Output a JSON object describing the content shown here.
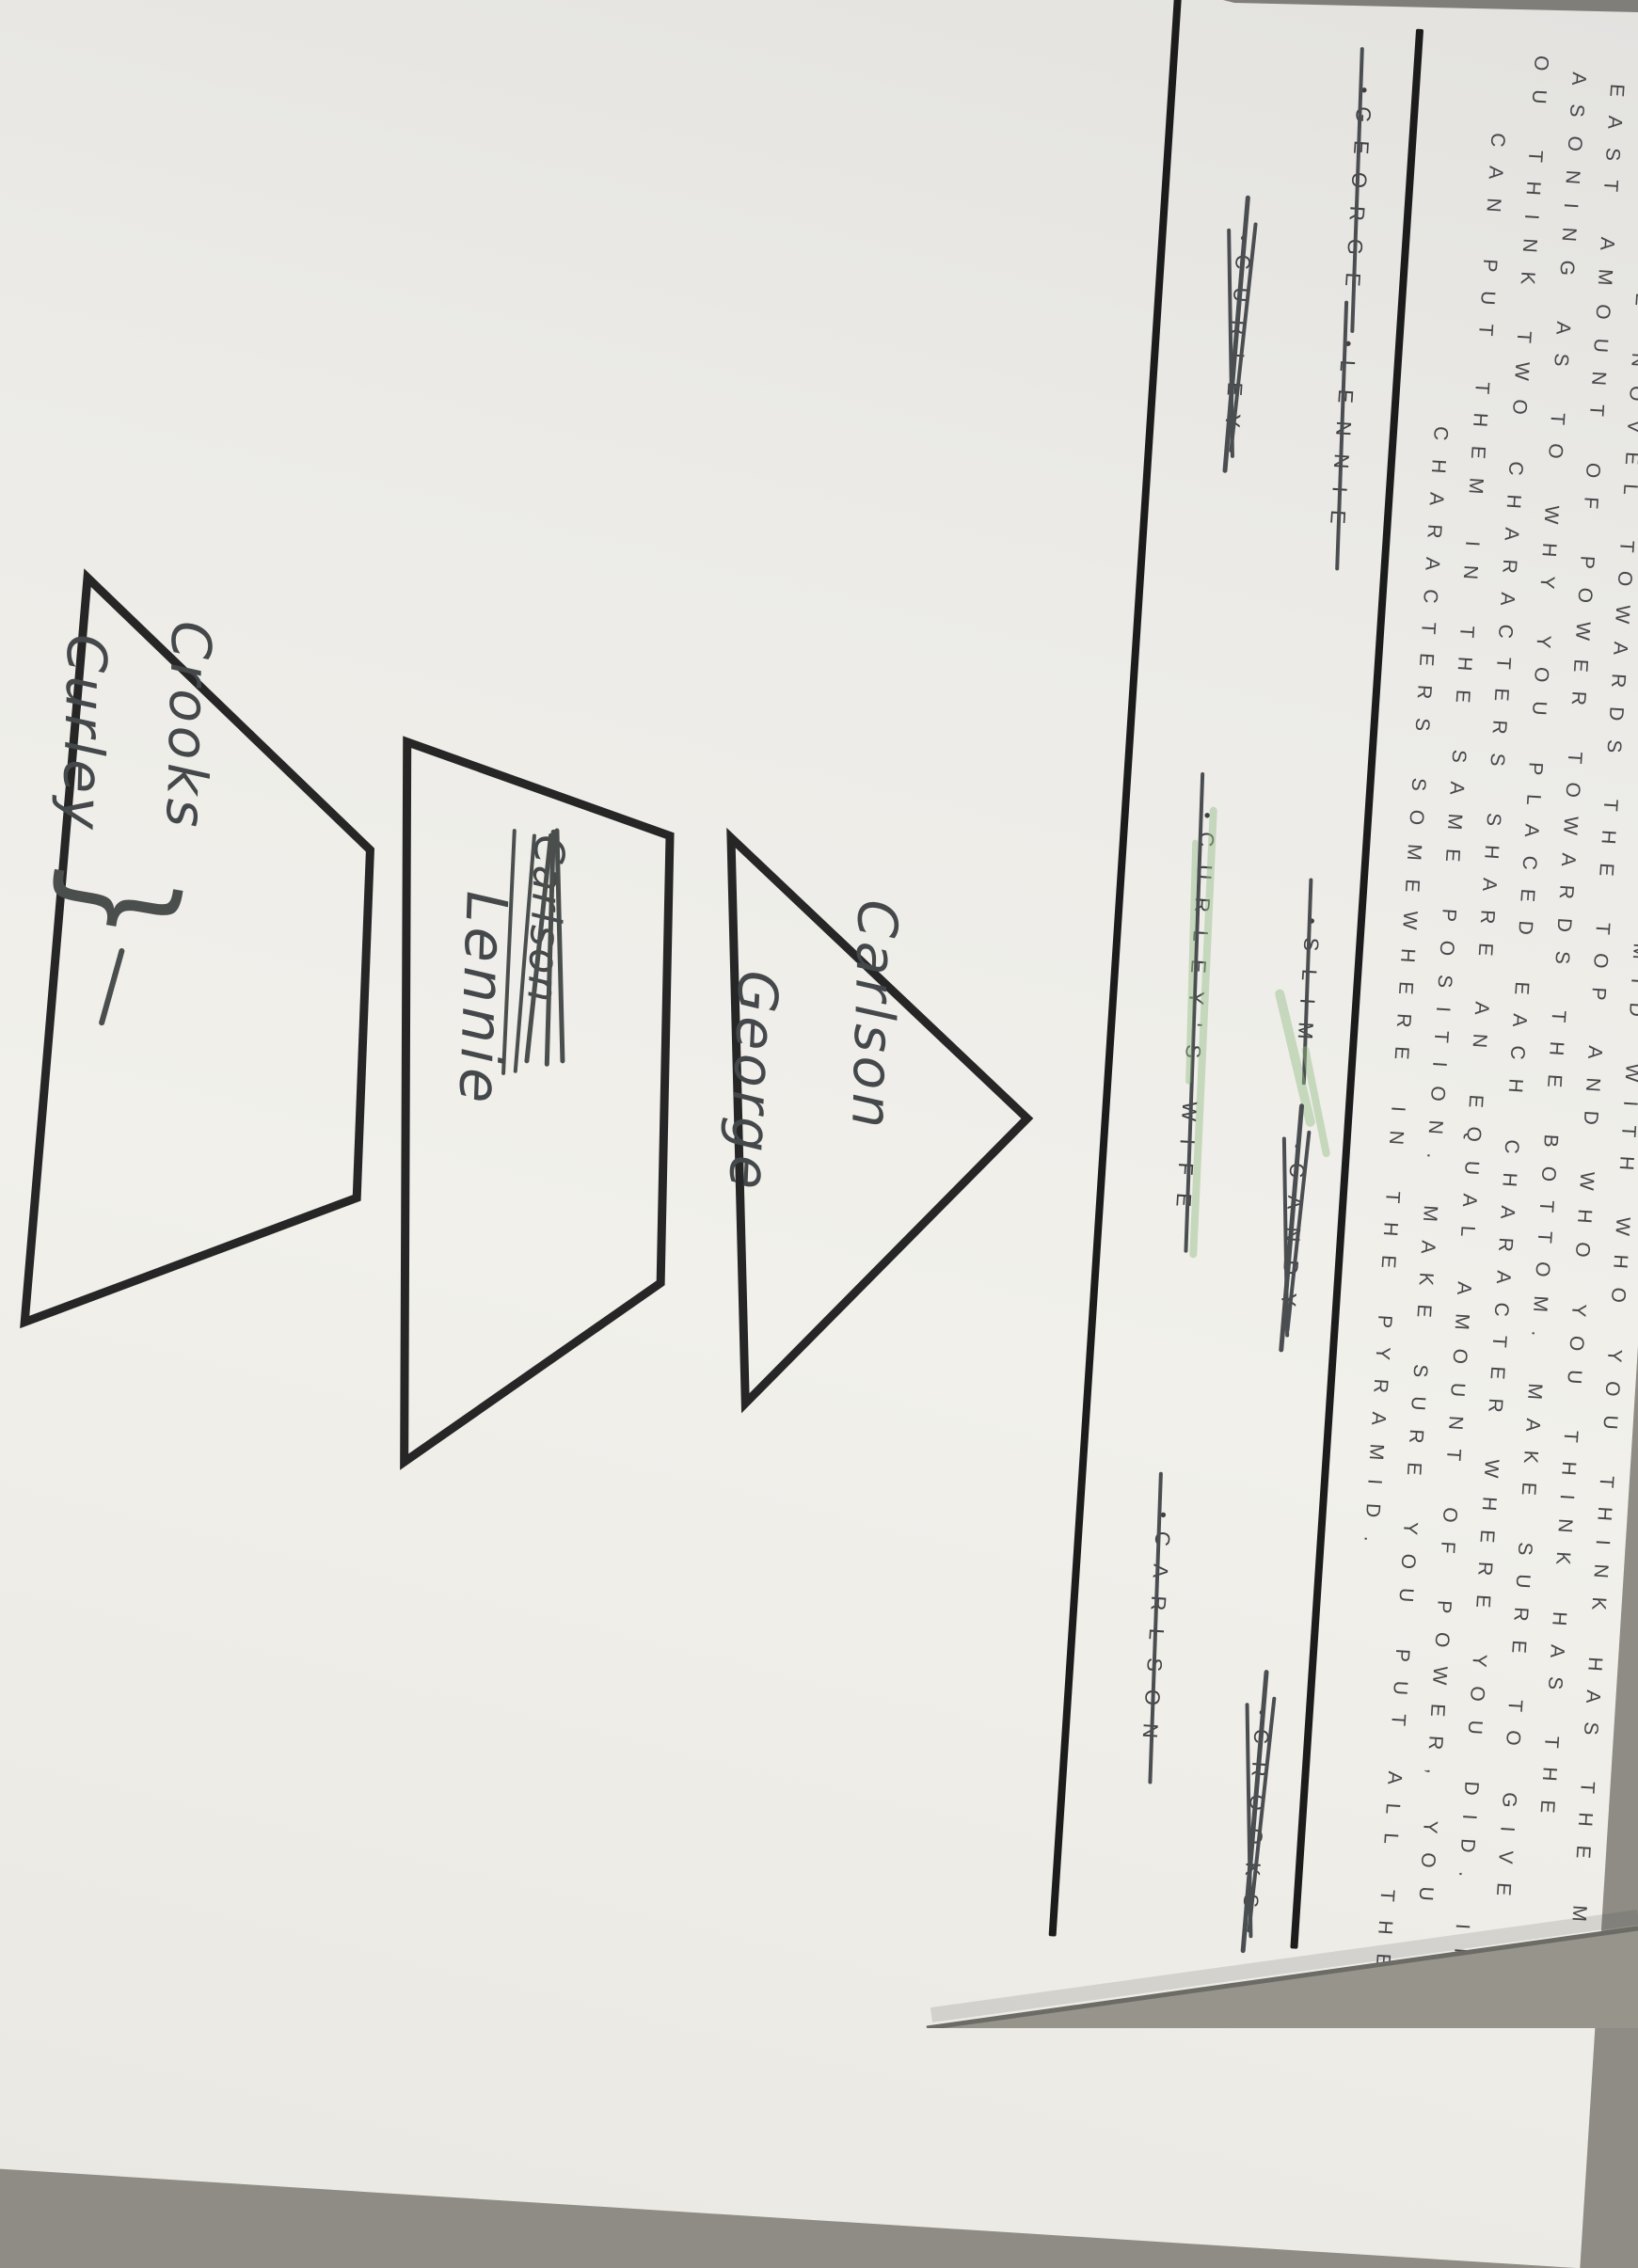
{
  "document": {
    "kind": "photographed worksheet, rotated on a table",
    "paragraph": {
      "lines": [
        "MID WITH WHO YOU THINK HAS THE MOS",
        "E NOVEL TOWARDS THE TOP AND WHO YOU THINK HAS THE",
        "EAST AMOUNT OF POWER TOWARDS THE BOTTOM. MAKE SURE TO GIVE",
        "ASONING AS TO WHY YOU PLACED EACH CHARACTER WHERE YOU DID. IF",
        "OU THINK TWO CHARACTERS SHARE AN EQUAL AMOUNT OF POWER, YOU",
        "CAN PUT THEM IN THE SAME POSITION. MAKE SURE YOU PUT ALL THE",
        "CHARACTERS SOMEWHERE IN THE PYRAMID."
      ]
    }
  },
  "word_bank": {
    "bullet": "•",
    "row1": [
      {
        "label": "GEORGE",
        "struck": true,
        "style": "single"
      },
      {
        "label": "LENNIE",
        "struck": true,
        "style": "single"
      },
      {
        "label": "SLIM",
        "struck": true,
        "style": "single-green"
      },
      {
        "label": "CANDY",
        "struck": true,
        "style": "scribble"
      },
      {
        "label": "CROOKS",
        "struck": true,
        "style": "scribble"
      }
    ],
    "row2": [
      {
        "label": "CURLEY",
        "struck": true,
        "style": "scribble"
      },
      {
        "label": "CURLEY'S WIFE",
        "struck": true,
        "style": "single-green"
      },
      {
        "label": "CARLSON",
        "struck": true,
        "style": "single"
      }
    ]
  },
  "pyramid": {
    "tier1": {
      "line1": "Carlson",
      "line2": "George"
    },
    "tier2": {
      "scribbled_word": "Carlson",
      "line": "Lennie"
    },
    "tier3": {
      "line1": "Crooks",
      "line2": "Curley",
      "bracket": "}"
    }
  },
  "colors": {
    "paper": "#efeeea",
    "table_surface": "#97948c",
    "printed_ink": "#47474b",
    "pen_ink": "#44484a",
    "divider_rule": "#1c1c1c",
    "green_highlight": "#92bd84"
  }
}
